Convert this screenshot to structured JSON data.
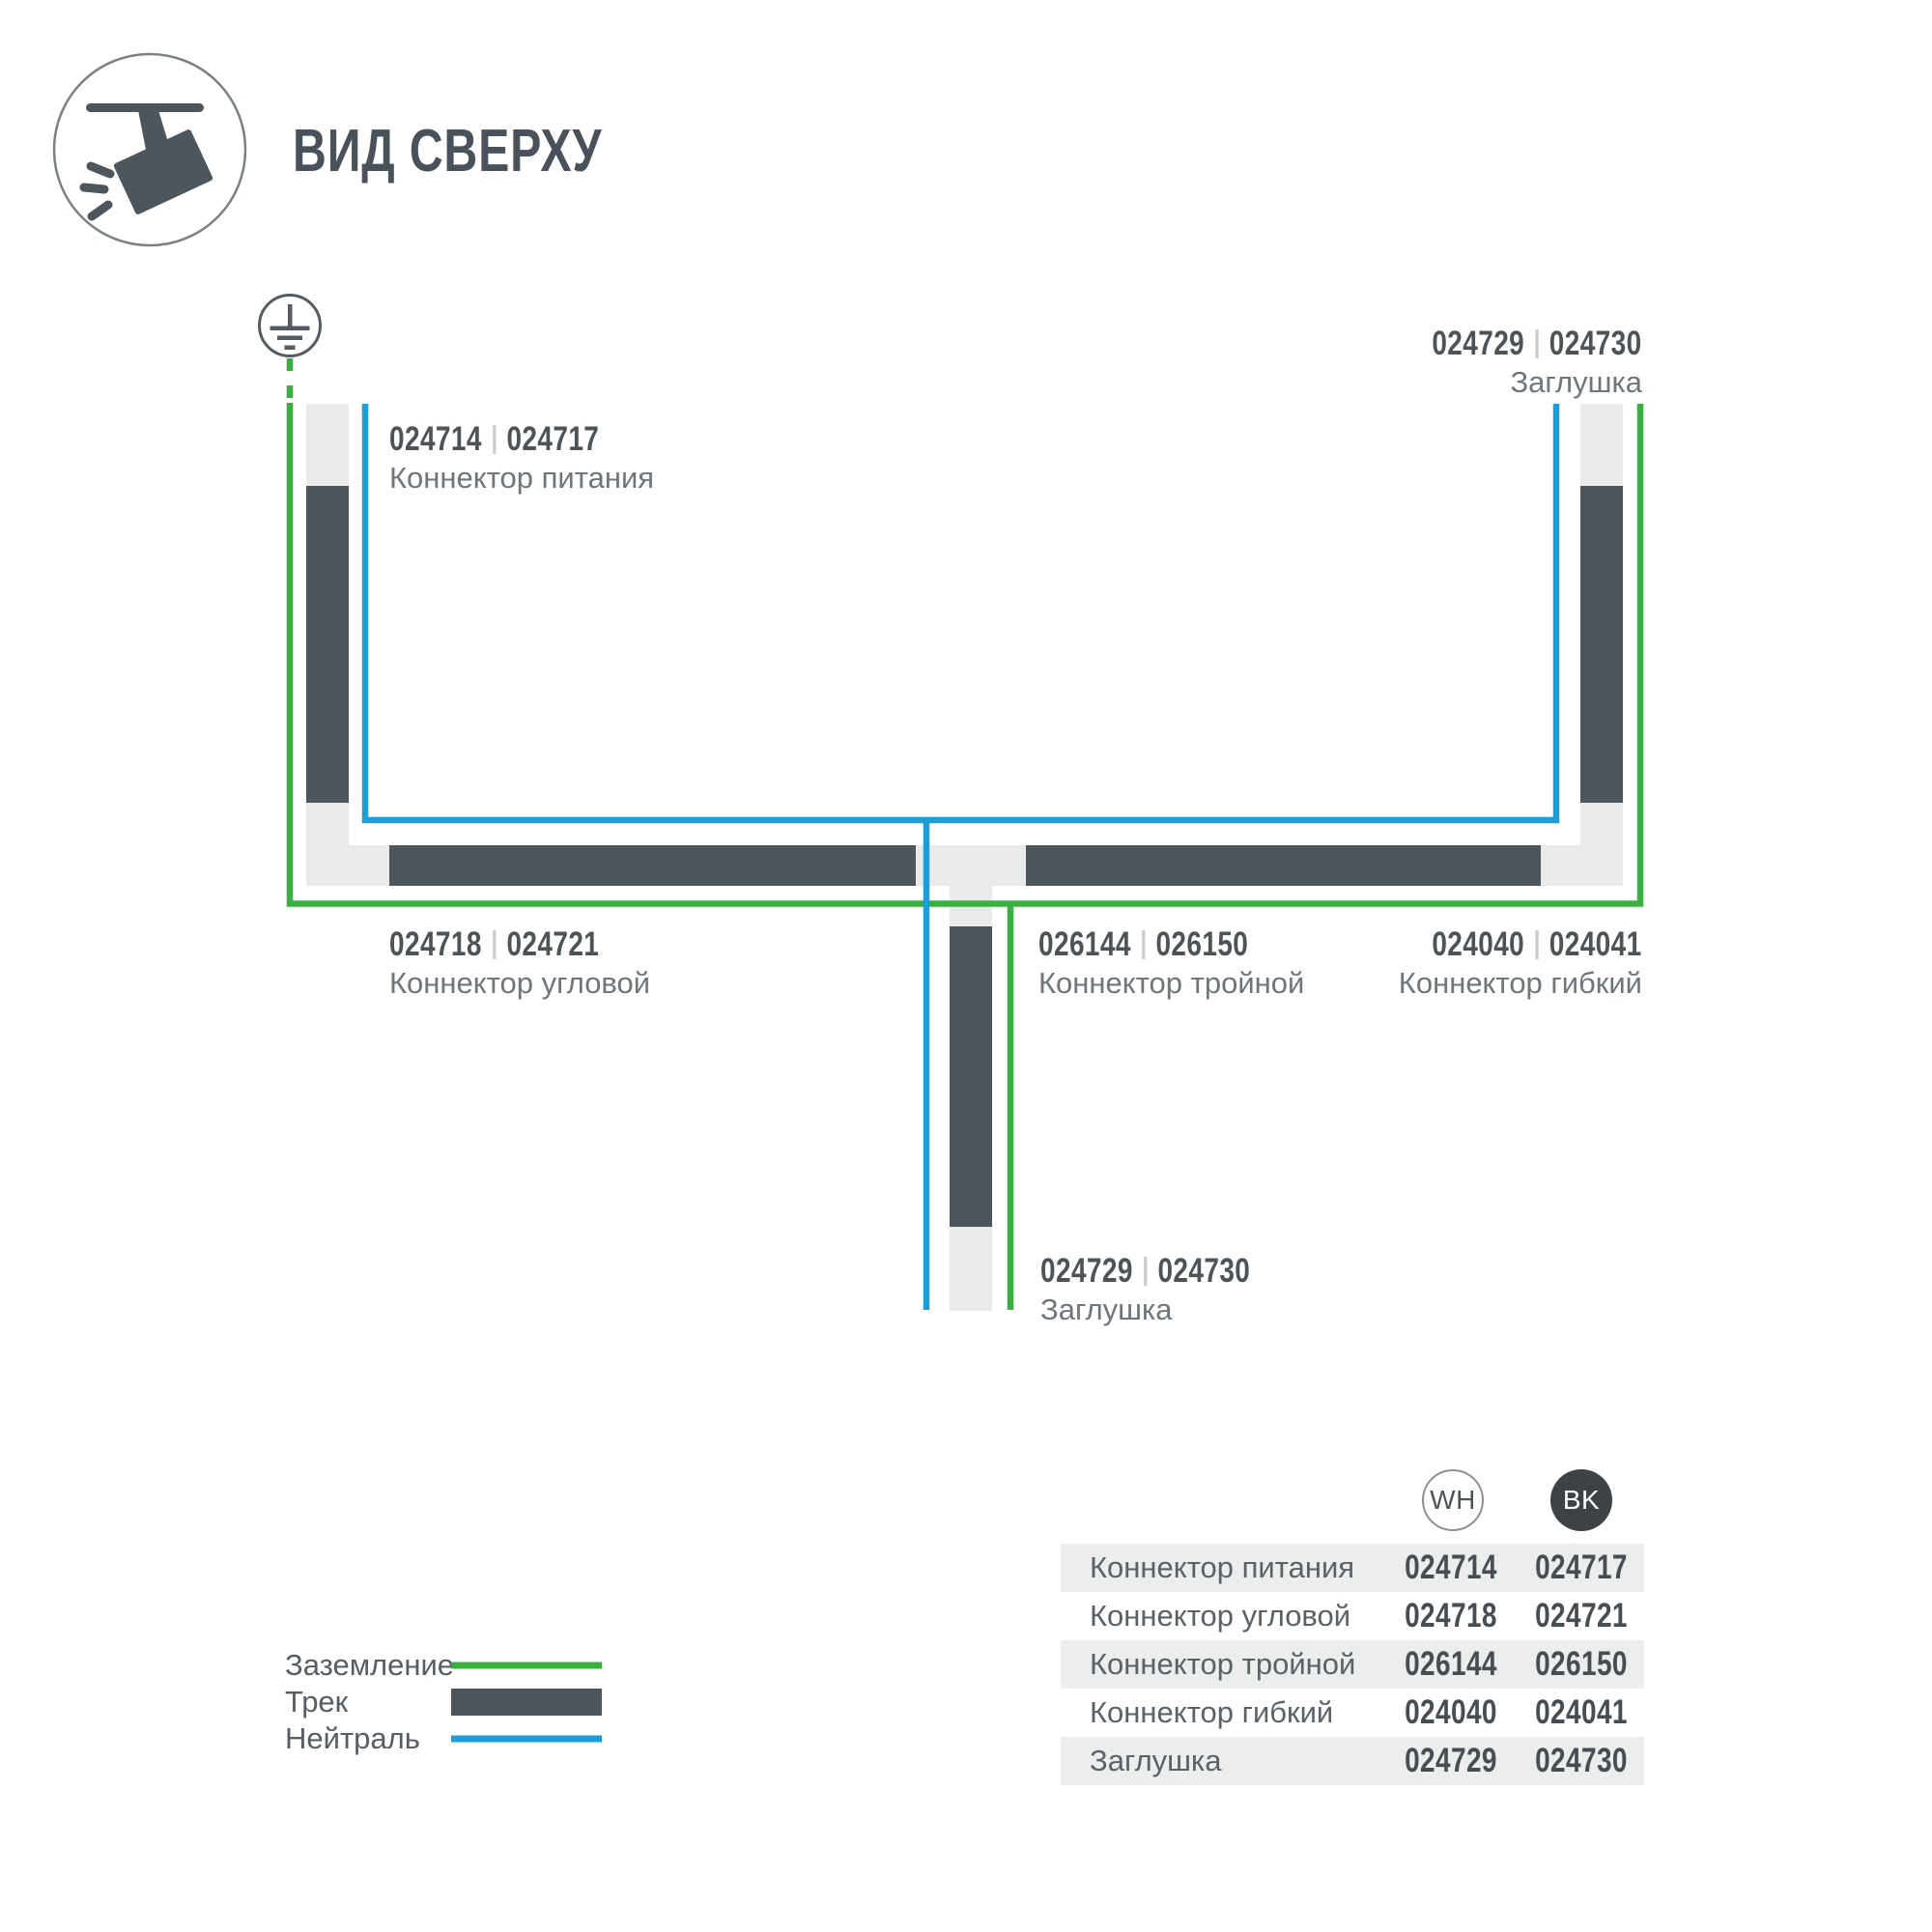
{
  "header": {
    "title": "ВИД СВЕРХУ"
  },
  "colors": {
    "green": "#3AAE41",
    "blue": "#1D9ED9",
    "track_dark": "#4D565C",
    "track_light": "#E9EBEB",
    "symbol_stroke": "#555C61",
    "icon_stroke": "#7A8184"
  },
  "diagram": {
    "labels": {
      "power": {
        "code_wh": "024714",
        "code_bk": "024717",
        "name": "Коннектор питания"
      },
      "end_cap_top": {
        "code_wh": "024729",
        "code_bk": "024730",
        "name": "Заглушка"
      },
      "corner": {
        "code_wh": "024718",
        "code_bk": "024721",
        "name": "Коннектор угловой"
      },
      "triple": {
        "code_wh": "026144",
        "code_bk": "026150",
        "name": "Коннектор тройной"
      },
      "flexible": {
        "code_wh": "024040",
        "code_bk": "024041",
        "name": "Коннектор гибкий"
      },
      "end_cap_bottom": {
        "code_wh": "024729",
        "code_bk": "024730",
        "name": "Заглушка"
      }
    }
  },
  "legend": {
    "items": [
      {
        "label": "Заземление",
        "swatch": "ground-line"
      },
      {
        "label": "Трек",
        "swatch": "track-bar"
      },
      {
        "label": "Нейтраль",
        "swatch": "neutral-line"
      }
    ]
  },
  "table": {
    "columns": [
      {
        "badge": "WH"
      },
      {
        "badge": "BK"
      }
    ],
    "rows": [
      {
        "label": "Коннектор питания",
        "wh": "024714",
        "bk": "024717"
      },
      {
        "label": "Коннектор угловой",
        "wh": "024718",
        "bk": "024721"
      },
      {
        "label": "Коннектор тройной",
        "wh": "026144",
        "bk": "026150"
      },
      {
        "label": "Коннектор гибкий",
        "wh": "024040",
        "bk": "024041"
      },
      {
        "label": "Заглушка",
        "wh": "024729",
        "bk": "024730"
      }
    ]
  }
}
